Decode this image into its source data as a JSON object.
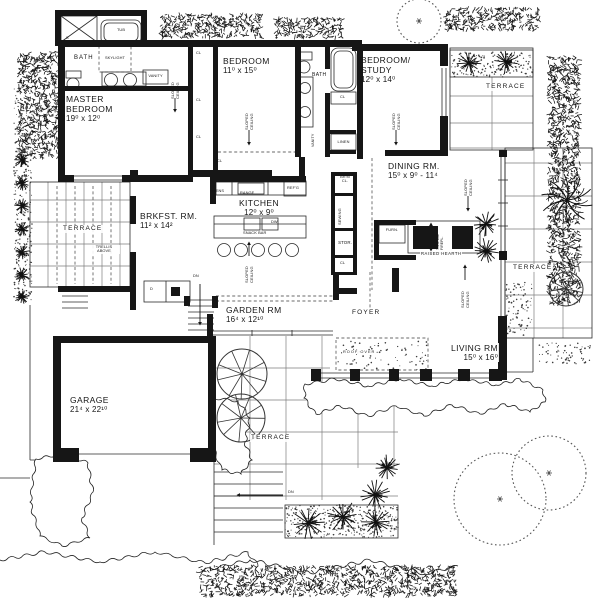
{
  "meta": {
    "type": "architectural floor plan, black-and-white line drawing",
    "colors": {
      "ink": "#161616",
      "paper": "#ffffff"
    }
  },
  "rooms": {
    "master_bedroom": {
      "name": "MASTER\nBEDROOM",
      "dims": "19⁰ x 12⁰"
    },
    "bedroom": {
      "name": "BEDROOM",
      "dims": "11⁰ x 15⁰"
    },
    "bedroom_study": {
      "name": "BEDROOM/\nSTUDY",
      "dims": "12⁰ x 14⁰"
    },
    "dining_room": {
      "name": "DINING RM.",
      "dims": "15⁰ x 9⁰ - 11⁴"
    },
    "kitchen": {
      "name": "KITCHEN",
      "dims": "12⁰ x 9⁰"
    },
    "breakfast_room": {
      "name": "BRKFST. RM.",
      "dims": "11² x 14²"
    },
    "garden_room": {
      "name": "GARDEN RM",
      "dims": "16⁴ x 12¹⁰"
    },
    "living_room": {
      "name": "LIVING RM",
      "dims": "15⁰ x 16⁰"
    },
    "garage": {
      "name": "GARAGE",
      "dims": "21⁴ x 22¹⁰"
    },
    "foyer": {
      "name": "FOYER"
    }
  },
  "labels": {
    "terrace": "TERRACE",
    "bath": "BATH",
    "trellis": "TRELLIS\nABOVE",
    "sloped_ceiling": "SLOPED\nCEILING",
    "raised_hearth": "RAISED HEARTH",
    "fireplace": "TWO-WAY\nFIREPL.",
    "furnace": "FURN.",
    "skylight": "SKYLIGHT",
    "tub": "TUB",
    "shower": "S",
    "vanity": "VANITY",
    "linen": "LINEN",
    "closet": "CL",
    "ovens": "OVENS",
    "range": "RANGE",
    "refrigerator": "REF'G",
    "dishwasher": "DW",
    "snack_bar": "SNACK BAR",
    "broom_closet": "BR'M\nCL.",
    "sewing": "SEWING",
    "storage": "STOR.",
    "down": "DN",
    "dryer": "D",
    "roof_over": "ROOF OVER"
  }
}
